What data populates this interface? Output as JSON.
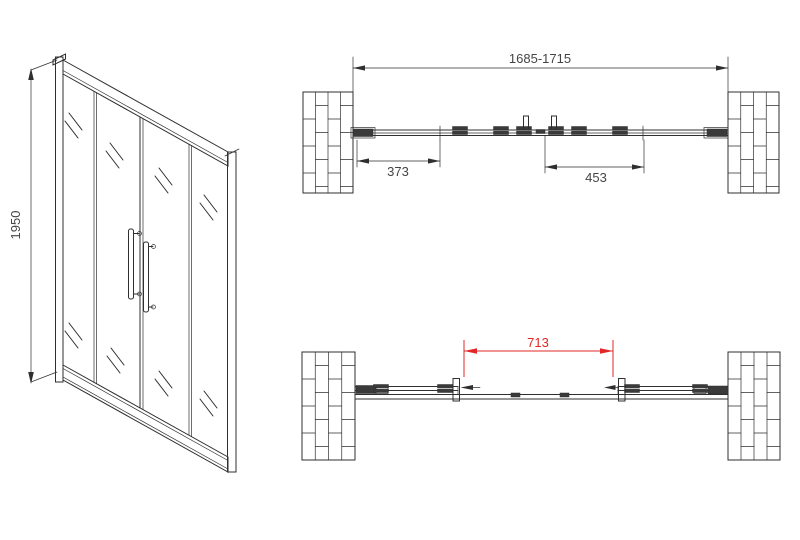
{
  "front_view": {
    "height_dim_label": "1950"
  },
  "plan_view_closed": {
    "overall_width_label": "1685-1715",
    "left_panel_label": "373",
    "right_panel_label": "453"
  },
  "plan_view_open": {
    "clear_opening_label": "713"
  },
  "colors": {
    "line": "#2f2f2f",
    "dim_text": "#454545",
    "red_dim": "#e12727",
    "background": "#ffffff"
  }
}
